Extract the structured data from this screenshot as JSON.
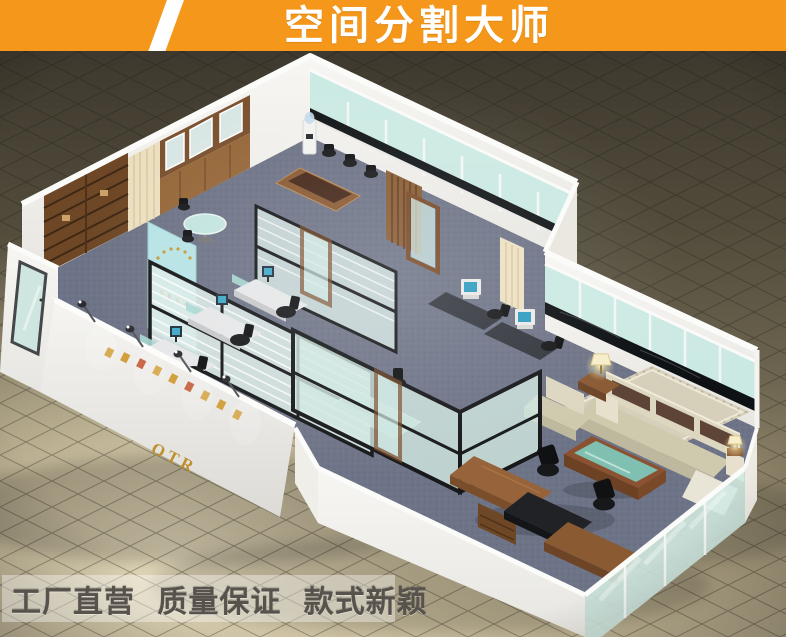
{
  "banner": {
    "title": "空间分割大师",
    "bg_color": "#F5971A",
    "text_color": "#FFFFFF"
  },
  "footer": {
    "slogan": "工厂直营 质量保证 款式新颖",
    "text_color": "#57524B"
  },
  "scene": {
    "description": "3D isometric render of an office showroom divided by black-framed glass partitions: open-plan workstations with monitors, glass meeting room, conference area with water cooler, wooden cabinets and shelving, and an executive suite with cream sofa, table lamps, green glass coffee table and executive desk, all on a dark tiled showroom floor",
    "logo_text": "OTR",
    "colors": {
      "wall_white": "#F1F0EC",
      "glass": "#C9E9E3",
      "partition_frame": "#17181A",
      "wood": "#8A5A33",
      "carpet": "#6E7487",
      "floor_tile": "#D9D0B2",
      "background": "#3E3A2E",
      "lamp_glow": "#FFEFA9",
      "sofa_cushion": "#5D4437",
      "table_glass": "#7FC0B2"
    }
  }
}
